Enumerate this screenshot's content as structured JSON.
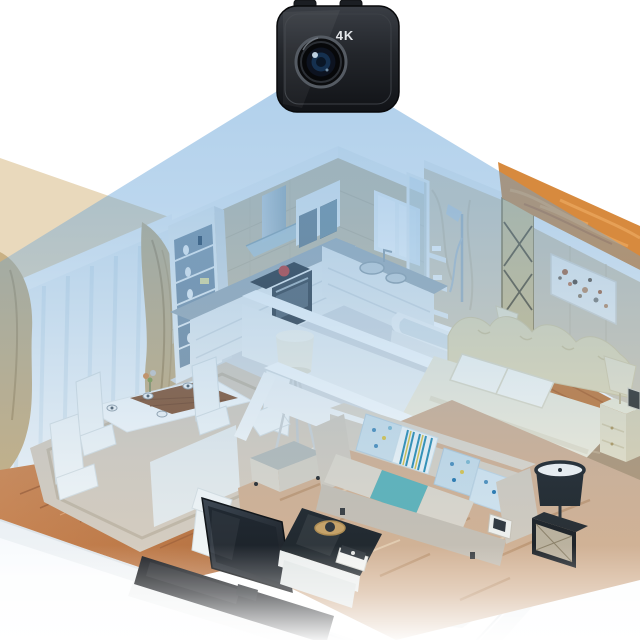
{
  "camera": {
    "label": "4K",
    "type": "mini-wifi-security-camera",
    "mounted": "top-center, lens facing down into apartment"
  },
  "beam": {
    "description": "blue field-of-view cone projected from camera lens over the apartment",
    "apex": "camera lens",
    "spread": "full width of flat"
  },
  "scene": {
    "style": "isometric cutaway apartment 3D render",
    "rooms": [
      {
        "name": "kitchen",
        "objects": [
          "beige tile wall",
          "window",
          "range hood",
          "wall cabinet",
          "L-shaped white counter",
          "oven",
          "cooktop with red pot",
          "double sink",
          "white bar counter",
          "tall display shelf with vases"
        ]
      },
      {
        "name": "dining room",
        "objects": [
          "sheer curtains",
          "gold drapes",
          "white dining table with wood runner",
          "five white chairs",
          "place settings",
          "beige area rug",
          "wood plank floor",
          "white tripod floor lamp"
        ]
      },
      {
        "name": "bathroom",
        "objects": [
          "marble shower wall",
          "glass shower panel",
          "shower set with corner shelves",
          "white bathtub"
        ]
      },
      {
        "name": "bedroom",
        "objects": [
          "orange marble accent wall",
          "gold lattice divider",
          "abstract painting",
          "cream double bed",
          "white pillows",
          "two nightstands",
          "table lamps",
          "photo frame",
          "patterned rug",
          "wood floor"
        ]
      },
      {
        "name": "living room",
        "objects": [
          "beige fabric sofa",
          "patterned throw pillows",
          "striped pillow",
          "teal seat cushion",
          "ottoman",
          "coffee table with tray and books",
          "flat-screen tv",
          "black tv stand",
          "black side table with mirror front",
          "black drum floor lamp",
          "large beige rug",
          "white half-wall partition"
        ]
      }
    ]
  },
  "palette": {
    "beam_blue": "#66a3d8",
    "accent_teal": "#5fb3b9",
    "orange_wall": "#d78a3e",
    "gold_curtain": "#c9b184",
    "rug_beige": "#d3b294",
    "wood_light": "#d28a54",
    "wood_dark": "#b06a38",
    "bedroom_wood": "#c97d3c",
    "camera_black": "#1b1e23",
    "tile_wall": "#cec1a5"
  }
}
